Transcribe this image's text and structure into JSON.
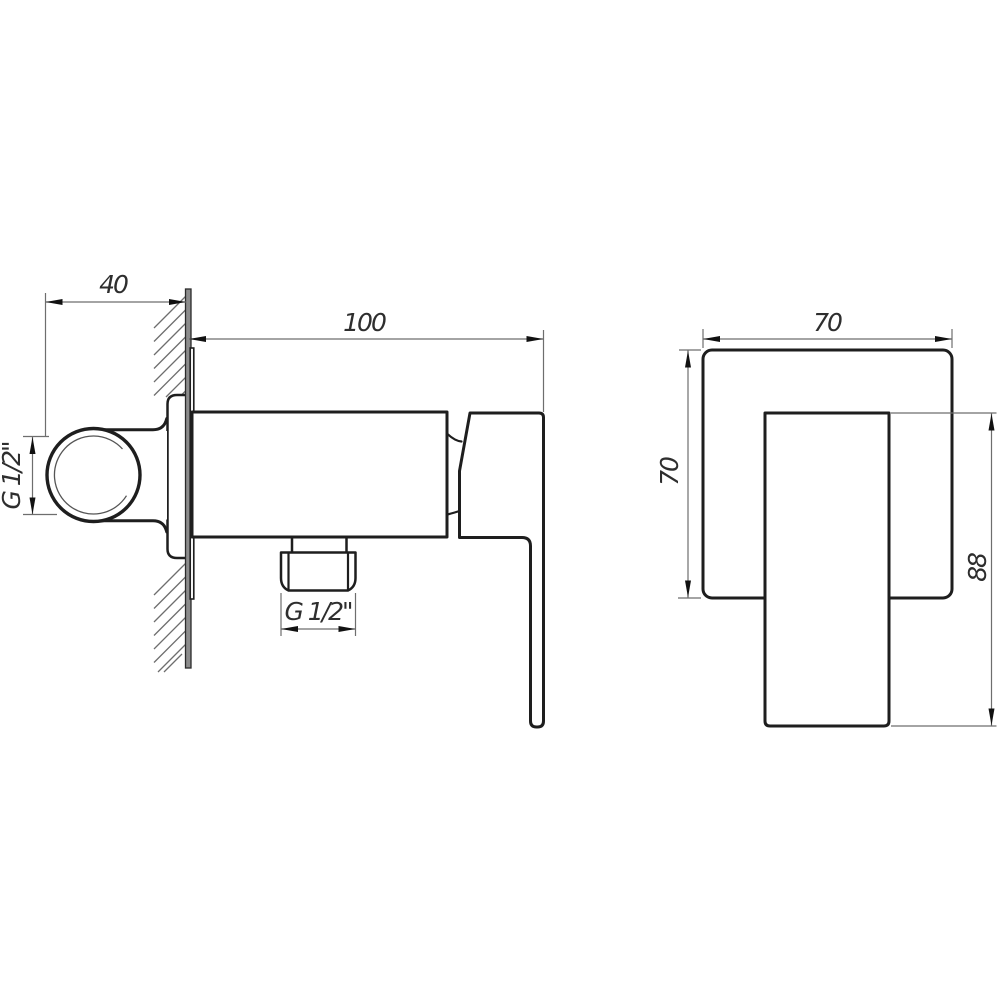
{
  "drawing": {
    "type": "technical-dimension-drawing",
    "views": {
      "side_view": "faucet side view with wall section",
      "front_view": "faucet front view"
    },
    "dimensions": {
      "wall_depth": {
        "label": "40"
      },
      "body_length": {
        "label": "100"
      },
      "inlet_thread": {
        "label": "G 1/2\""
      },
      "outlet_thread": {
        "label": "G 1/2\""
      },
      "plate_width": {
        "label": "70"
      },
      "plate_height": {
        "label": "70"
      },
      "handle_height": {
        "label": "88"
      }
    },
    "colors": {
      "background": "#ffffff",
      "outline": "#1e1e1e",
      "thin_line": "#6e6e6e",
      "wall_fill": "#8c8c8c",
      "arrow": "#111111",
      "text": "#2e2e2e"
    }
  }
}
